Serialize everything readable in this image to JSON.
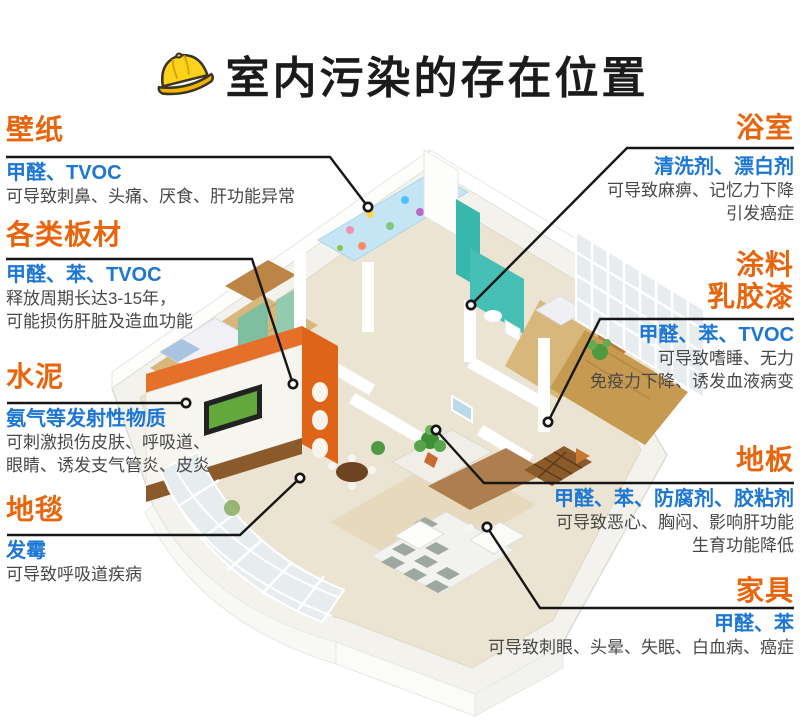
{
  "header": {
    "icon": "hard-hat-icon",
    "title": "室内污染的存在位置"
  },
  "colors": {
    "accent_orange": "#E8650D",
    "accent_blue": "#1C76D3",
    "body_text": "#484848",
    "leader_line": "#161616",
    "helmet_yellow": "#FCD21C"
  },
  "callouts": {
    "left": [
      {
        "title": "壁纸",
        "pollutants": "甲醛、TVOC",
        "desc": [
          "可导致刺鼻、头痛、厌食、肝功能异常"
        ]
      },
      {
        "title": "各类板材",
        "pollutants": "甲醛、苯、TVOC",
        "desc": [
          "释放周期长达3-15年，",
          "可能损伤肝脏及造血功能"
        ]
      },
      {
        "title": "水泥",
        "pollutants": "氨气等发射性物质",
        "desc": [
          "可刺激损伤皮肤、呼吸道、",
          "眼睛、诱发支气管炎、皮炎"
        ]
      },
      {
        "title": "地毯",
        "pollutants": "发霉",
        "desc": [
          "可导致呼吸道疾病"
        ]
      }
    ],
    "right": [
      {
        "title": "浴室",
        "pollutants": "清洗剂、漂白剂",
        "desc": [
          "可导致麻痹、记忆力下降",
          "引发癌症"
        ]
      },
      {
        "title_lines": [
          "涂料",
          "乳胶漆"
        ],
        "pollutants": "甲醛、苯、TVOC",
        "desc": [
          "可导致嗜睡、无力",
          "免疫力下降、诱发血液病变"
        ]
      },
      {
        "title": "地板",
        "pollutants": "甲醛、苯、防腐剂、胶粘剂",
        "desc": [
          "可导致恶心、胸闷、影响肝功能",
          "生育功能降低"
        ]
      },
      {
        "title": "家具",
        "pollutants": "甲醛、苯",
        "desc": [
          "可导致刺眼、头晕、失眠、白血病、癌症"
        ]
      }
    ]
  }
}
